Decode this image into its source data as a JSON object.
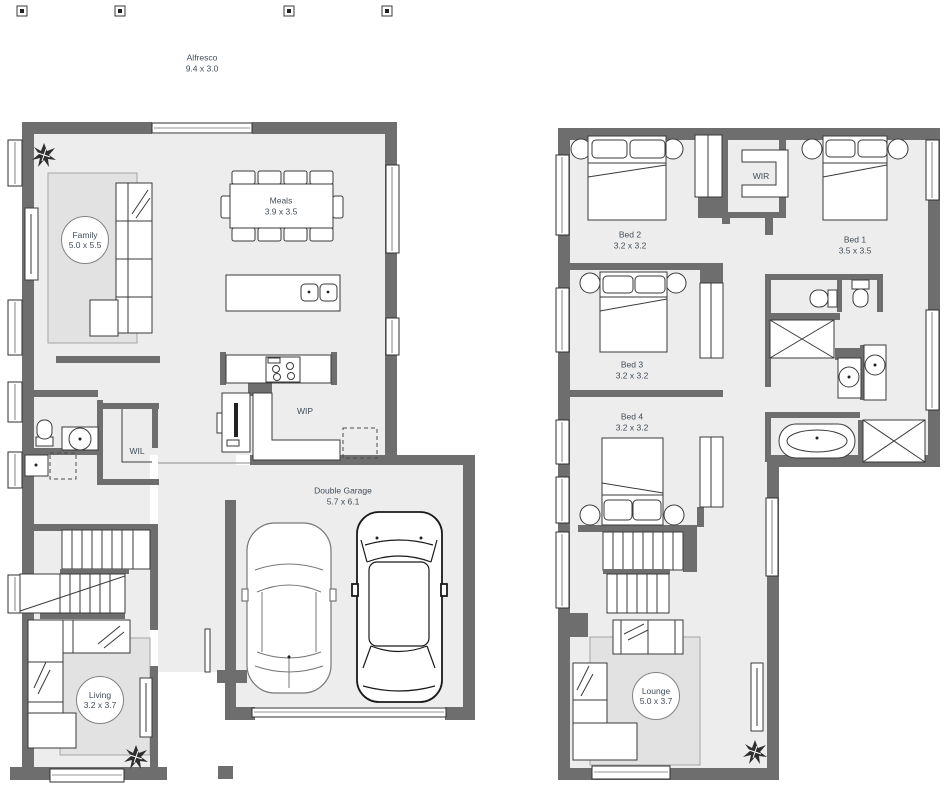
{
  "title": "Two storey house floor plan",
  "colors": {
    "wall": "#6e6e6e",
    "floor": "#ededed",
    "rug": "#e2e2e2",
    "label_text": "#424c57"
  },
  "ground_floor": {
    "labels": {
      "alfresco": {
        "name": "Alfresco",
        "dims": "9.4 x 3.0"
      },
      "family": {
        "name": "Family",
        "dims": "5.0 x 5.5"
      },
      "meals": {
        "name": "Meals",
        "dims": "3.9 x 3.5"
      },
      "wip": {
        "name": "WIP"
      },
      "wil": {
        "name": "WIL"
      },
      "garage": {
        "name": "Double Garage",
        "dims": "5.7 x 6.1"
      },
      "living": {
        "name": "Living",
        "dims": "3.2 x 3.7"
      }
    }
  },
  "upper_floor": {
    "labels": {
      "bed1": {
        "name": "Bed 1",
        "dims": "3.5 x 3.5"
      },
      "bed2": {
        "name": "Bed 2",
        "dims": "3.2 x 3.2"
      },
      "bed3": {
        "name": "Bed 3",
        "dims": "3.2 x 3.2"
      },
      "bed4": {
        "name": "Bed 4",
        "dims": "3.2 x 3.2"
      },
      "wir": {
        "name": "WIR"
      },
      "lounge": {
        "name": "Lounge",
        "dims": "5.0 x 3.7"
      }
    }
  }
}
